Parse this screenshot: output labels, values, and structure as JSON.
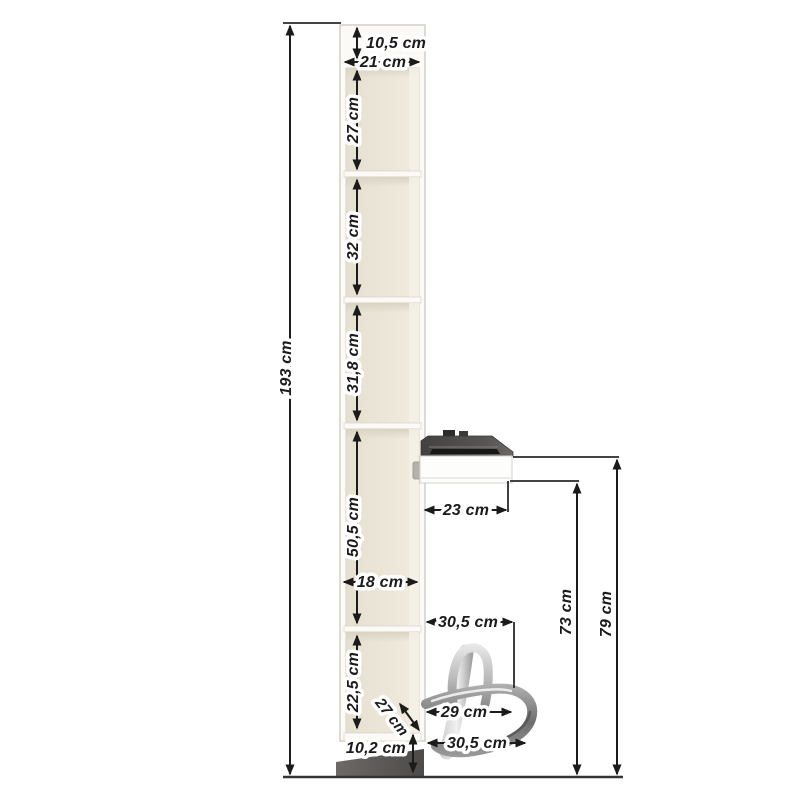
{
  "diagram": {
    "title": "shelf-unit-dimension-diagram",
    "product": "tall narrow cabinet with five open shelves, fold-out desk and chrome footrest",
    "units": "cm",
    "dims": {
      "total_height": "193 cm",
      "top_offset": "10,5 cm",
      "outer_width": "21 cm",
      "shelf1_height": "27 cm",
      "shelf2_height": "32 cm",
      "shelf3_height": "31,8 cm",
      "shelf4_height": "50,5 cm",
      "inner_width": "18 cm",
      "shelf5_height": "22,5 cm",
      "depth_diagonal": "27 cm",
      "plinth_height": "10,2 cm",
      "desk_depth": "23 cm",
      "desk_top_height": "79 cm",
      "desk_under_height": "73 cm",
      "footrest_top_width": "30,5 cm",
      "footrest_mid_width": "29 cm",
      "footrest_bottom_width": "30,5 cm"
    },
    "colors": {
      "line": "#1b1b1b",
      "body": "#fbfaf7",
      "body_edge": "#d2cfc7",
      "interior": "#ebe5d7",
      "desk_top": "#4e4d4b",
      "desk_slot": "#181818",
      "drawer_front": "#fdfdfc",
      "plinth": "#5d5c5a",
      "chrome_light": "#f0f0f0",
      "chrome_dark": "#6e6e6e",
      "background": "#ffffff"
    }
  }
}
